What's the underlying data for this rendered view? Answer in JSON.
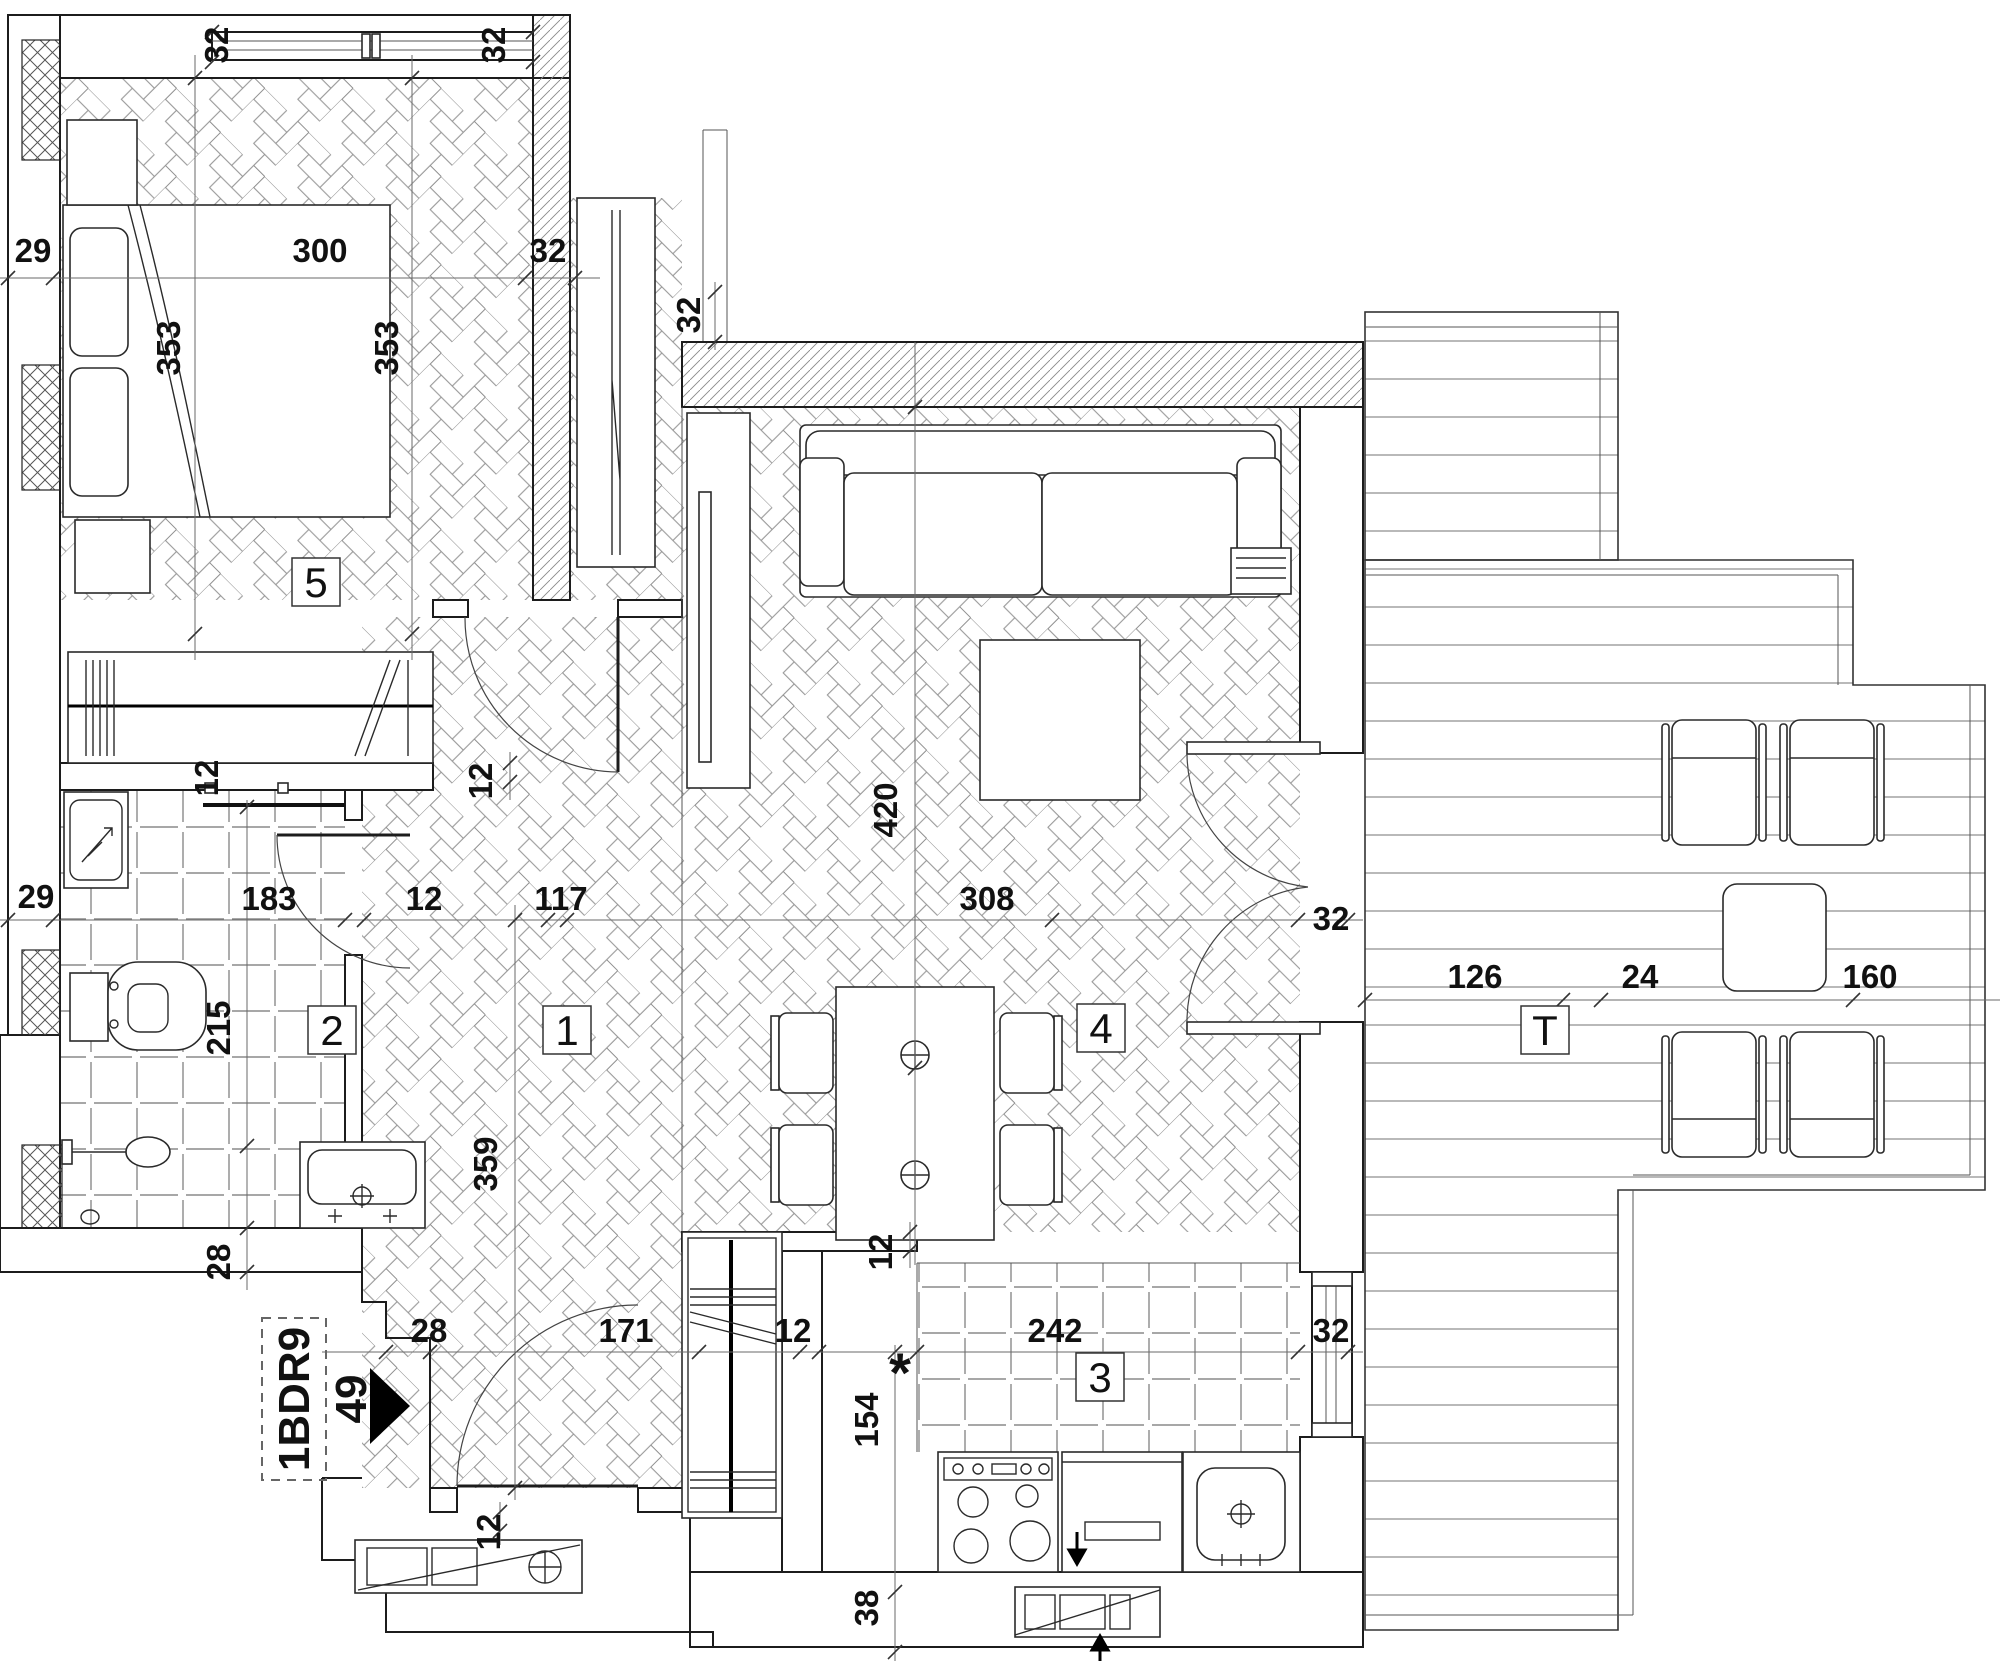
{
  "unit": {
    "code": "1BDR9",
    "area": "49"
  },
  "rooms": [
    {
      "label": "5",
      "cx": 316,
      "cy": 582,
      "name": "room-label-bedroom"
    },
    {
      "label": "2",
      "cx": 332,
      "cy": 1030,
      "name": "room-label-bathroom"
    },
    {
      "label": "1",
      "cx": 567,
      "cy": 1030,
      "name": "room-label-hallway"
    },
    {
      "label": "4",
      "cx": 1101,
      "cy": 1028,
      "name": "room-label-living"
    },
    {
      "label": "3",
      "cx": 1100,
      "cy": 1377,
      "name": "room-label-kitchen"
    },
    {
      "label": "T",
      "cx": 1545,
      "cy": 1030,
      "name": "room-label-terrace"
    }
  ],
  "dimensions": [
    {
      "t": "32",
      "x": 228,
      "y": 45,
      "r": -90
    },
    {
      "t": "32",
      "x": 505,
      "y": 45,
      "r": -90
    },
    {
      "t": "29",
      "x": 33,
      "y": 262,
      "r": 0
    },
    {
      "t": "300",
      "x": 320,
      "y": 262,
      "r": 0
    },
    {
      "t": "32",
      "x": 548,
      "y": 262,
      "r": 0
    },
    {
      "t": "353",
      "x": 180,
      "y": 348,
      "r": -90
    },
    {
      "t": "353",
      "x": 398,
      "y": 348,
      "r": -90
    },
    {
      "t": "32",
      "x": 700,
      "y": 315,
      "r": -90
    },
    {
      "t": "420",
      "x": 897,
      "y": 810,
      "r": -90
    },
    {
      "t": "12",
      "x": 492,
      "y": 781,
      "r": -90
    },
    {
      "t": "12",
      "x": 218,
      "y": 778,
      "r": -90
    },
    {
      "t": "29",
      "x": 36,
      "y": 908,
      "r": 0
    },
    {
      "t": "183",
      "x": 269,
      "y": 910,
      "r": 0
    },
    {
      "t": "12",
      "x": 424,
      "y": 910,
      "r": 0
    },
    {
      "t": "117",
      "x": 561,
      "y": 910,
      "r": 0
    },
    {
      "t": "308",
      "x": 987,
      "y": 910,
      "r": 0
    },
    {
      "t": "32",
      "x": 1331,
      "y": 930,
      "r": 0
    },
    {
      "t": "126",
      "x": 1475,
      "y": 988,
      "r": 0
    },
    {
      "t": "24",
      "x": 1640,
      "y": 988,
      "r": 0
    },
    {
      "t": "160",
      "x": 1870,
      "y": 988,
      "r": 0
    },
    {
      "t": "215",
      "x": 230,
      "y": 1028,
      "r": -90
    },
    {
      "t": "359",
      "x": 497,
      "y": 1164,
      "r": -90
    },
    {
      "t": "28",
      "x": 230,
      "y": 1262,
      "r": -90
    },
    {
      "t": "12",
      "x": 892,
      "y": 1252,
      "r": -90
    },
    {
      "t": "28",
      "x": 429,
      "y": 1342,
      "r": 0
    },
    {
      "t": "171",
      "x": 626,
      "y": 1342,
      "r": 0
    },
    {
      "t": "12",
      "x": 793,
      "y": 1342,
      "r": 0
    },
    {
      "t": "242",
      "x": 1055,
      "y": 1342,
      "r": 0
    },
    {
      "t": "32",
      "x": 1331,
      "y": 1342,
      "r": 0
    },
    {
      "t": "154",
      "x": 878,
      "y": 1420,
      "r": -90
    },
    {
      "t": "38",
      "x": 878,
      "y": 1608,
      "r": -90
    },
    {
      "t": "12",
      "x": 500,
      "y": 1532,
      "r": -90
    },
    {
      "t": "*",
      "x": 900,
      "y": 1392,
      "r": 0,
      "big": true
    }
  ]
}
